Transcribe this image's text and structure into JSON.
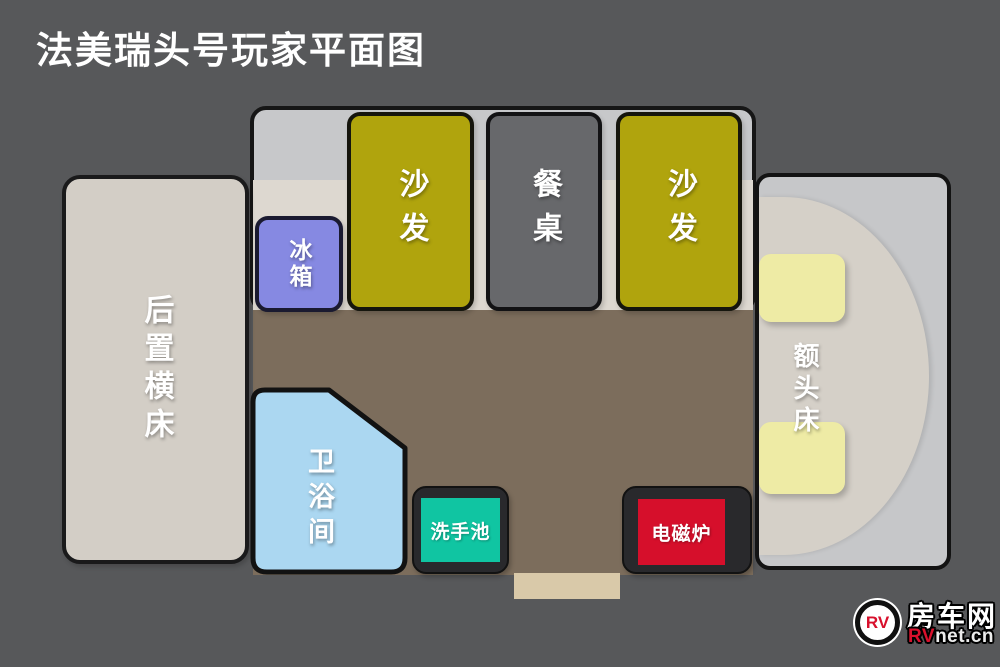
{
  "title": "法美瑞头号玩家平面图",
  "palette": {
    "background": "#57585a",
    "slideout": "#c7c8ca",
    "body_strip": "#ddd8d0",
    "floor": "#7c6d5c",
    "entry_step": "#d9c9a9",
    "border": "#151515",
    "label_text": "#ffffff"
  },
  "floorplan": {
    "rear_bed": {
      "label": "后置横床",
      "color": "#d3cec6"
    },
    "fridge": {
      "label": "冰箱",
      "color": "#8689e2"
    },
    "sofa_left": {
      "label": "沙发",
      "color": "#b0a40d"
    },
    "dining_table": {
      "label": "餐桌",
      "color": "#67686b"
    },
    "sofa_right": {
      "label": "沙发",
      "color": "#b0a40d"
    },
    "bathroom": {
      "label": "卫浴间",
      "color": "#abd7f1"
    },
    "sink": {
      "label": "洗手池",
      "color": "#10c5a2"
    },
    "cooker": {
      "label": "电磁炉",
      "color": "#d60f2b"
    },
    "front_bed": {
      "label": "额头床",
      "color": "#d5d0c8",
      "cushion_color": "#eeeba5"
    }
  },
  "logo": {
    "badge": "RV",
    "name": "房车网",
    "site_prefix": "RV",
    "site_suffix": "net.cn"
  }
}
